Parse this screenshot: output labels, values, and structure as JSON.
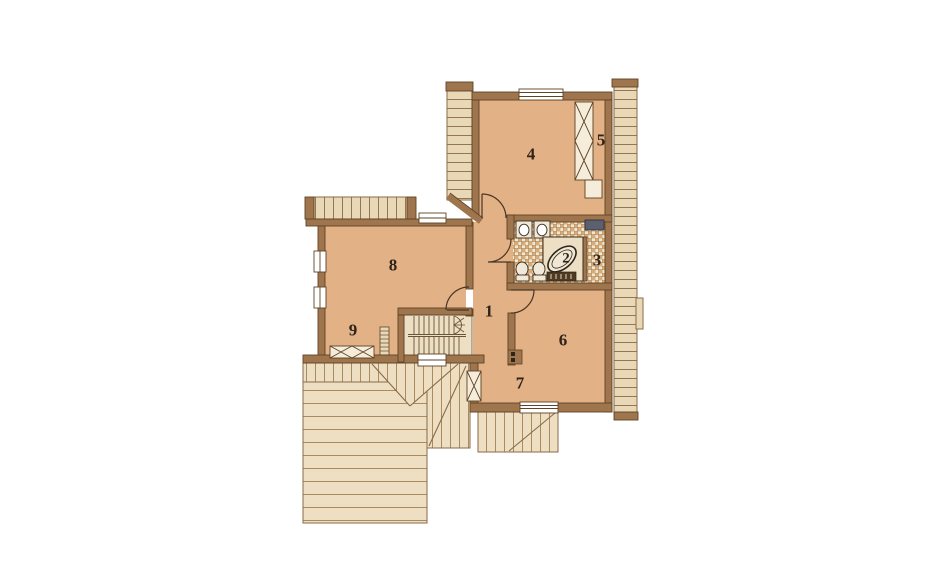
{
  "page": {
    "title": "Floor plan – upper storey"
  },
  "room_labels": [
    {
      "number": "1"
    },
    {
      "number": "2"
    },
    {
      "number": "3"
    },
    {
      "number": "4"
    },
    {
      "number": "5"
    },
    {
      "number": "6"
    },
    {
      "number": "7"
    },
    {
      "number": "8"
    },
    {
      "number": "9"
    }
  ],
  "colors": {
    "background": "#ffffff",
    "floor": "#e2b185",
    "wall": "#9f754d",
    "wall_outline": "#5e4326",
    "roof": "#eedfc2",
    "roof_line": "#a08254",
    "eave": "#e9d8b6",
    "tile_light": "#f1e8d2",
    "tile_dark": "#dcaa75",
    "fixture": "#f0e8d8",
    "dark_cabinet": "#5a6070",
    "label_text": "#2e241a"
  }
}
